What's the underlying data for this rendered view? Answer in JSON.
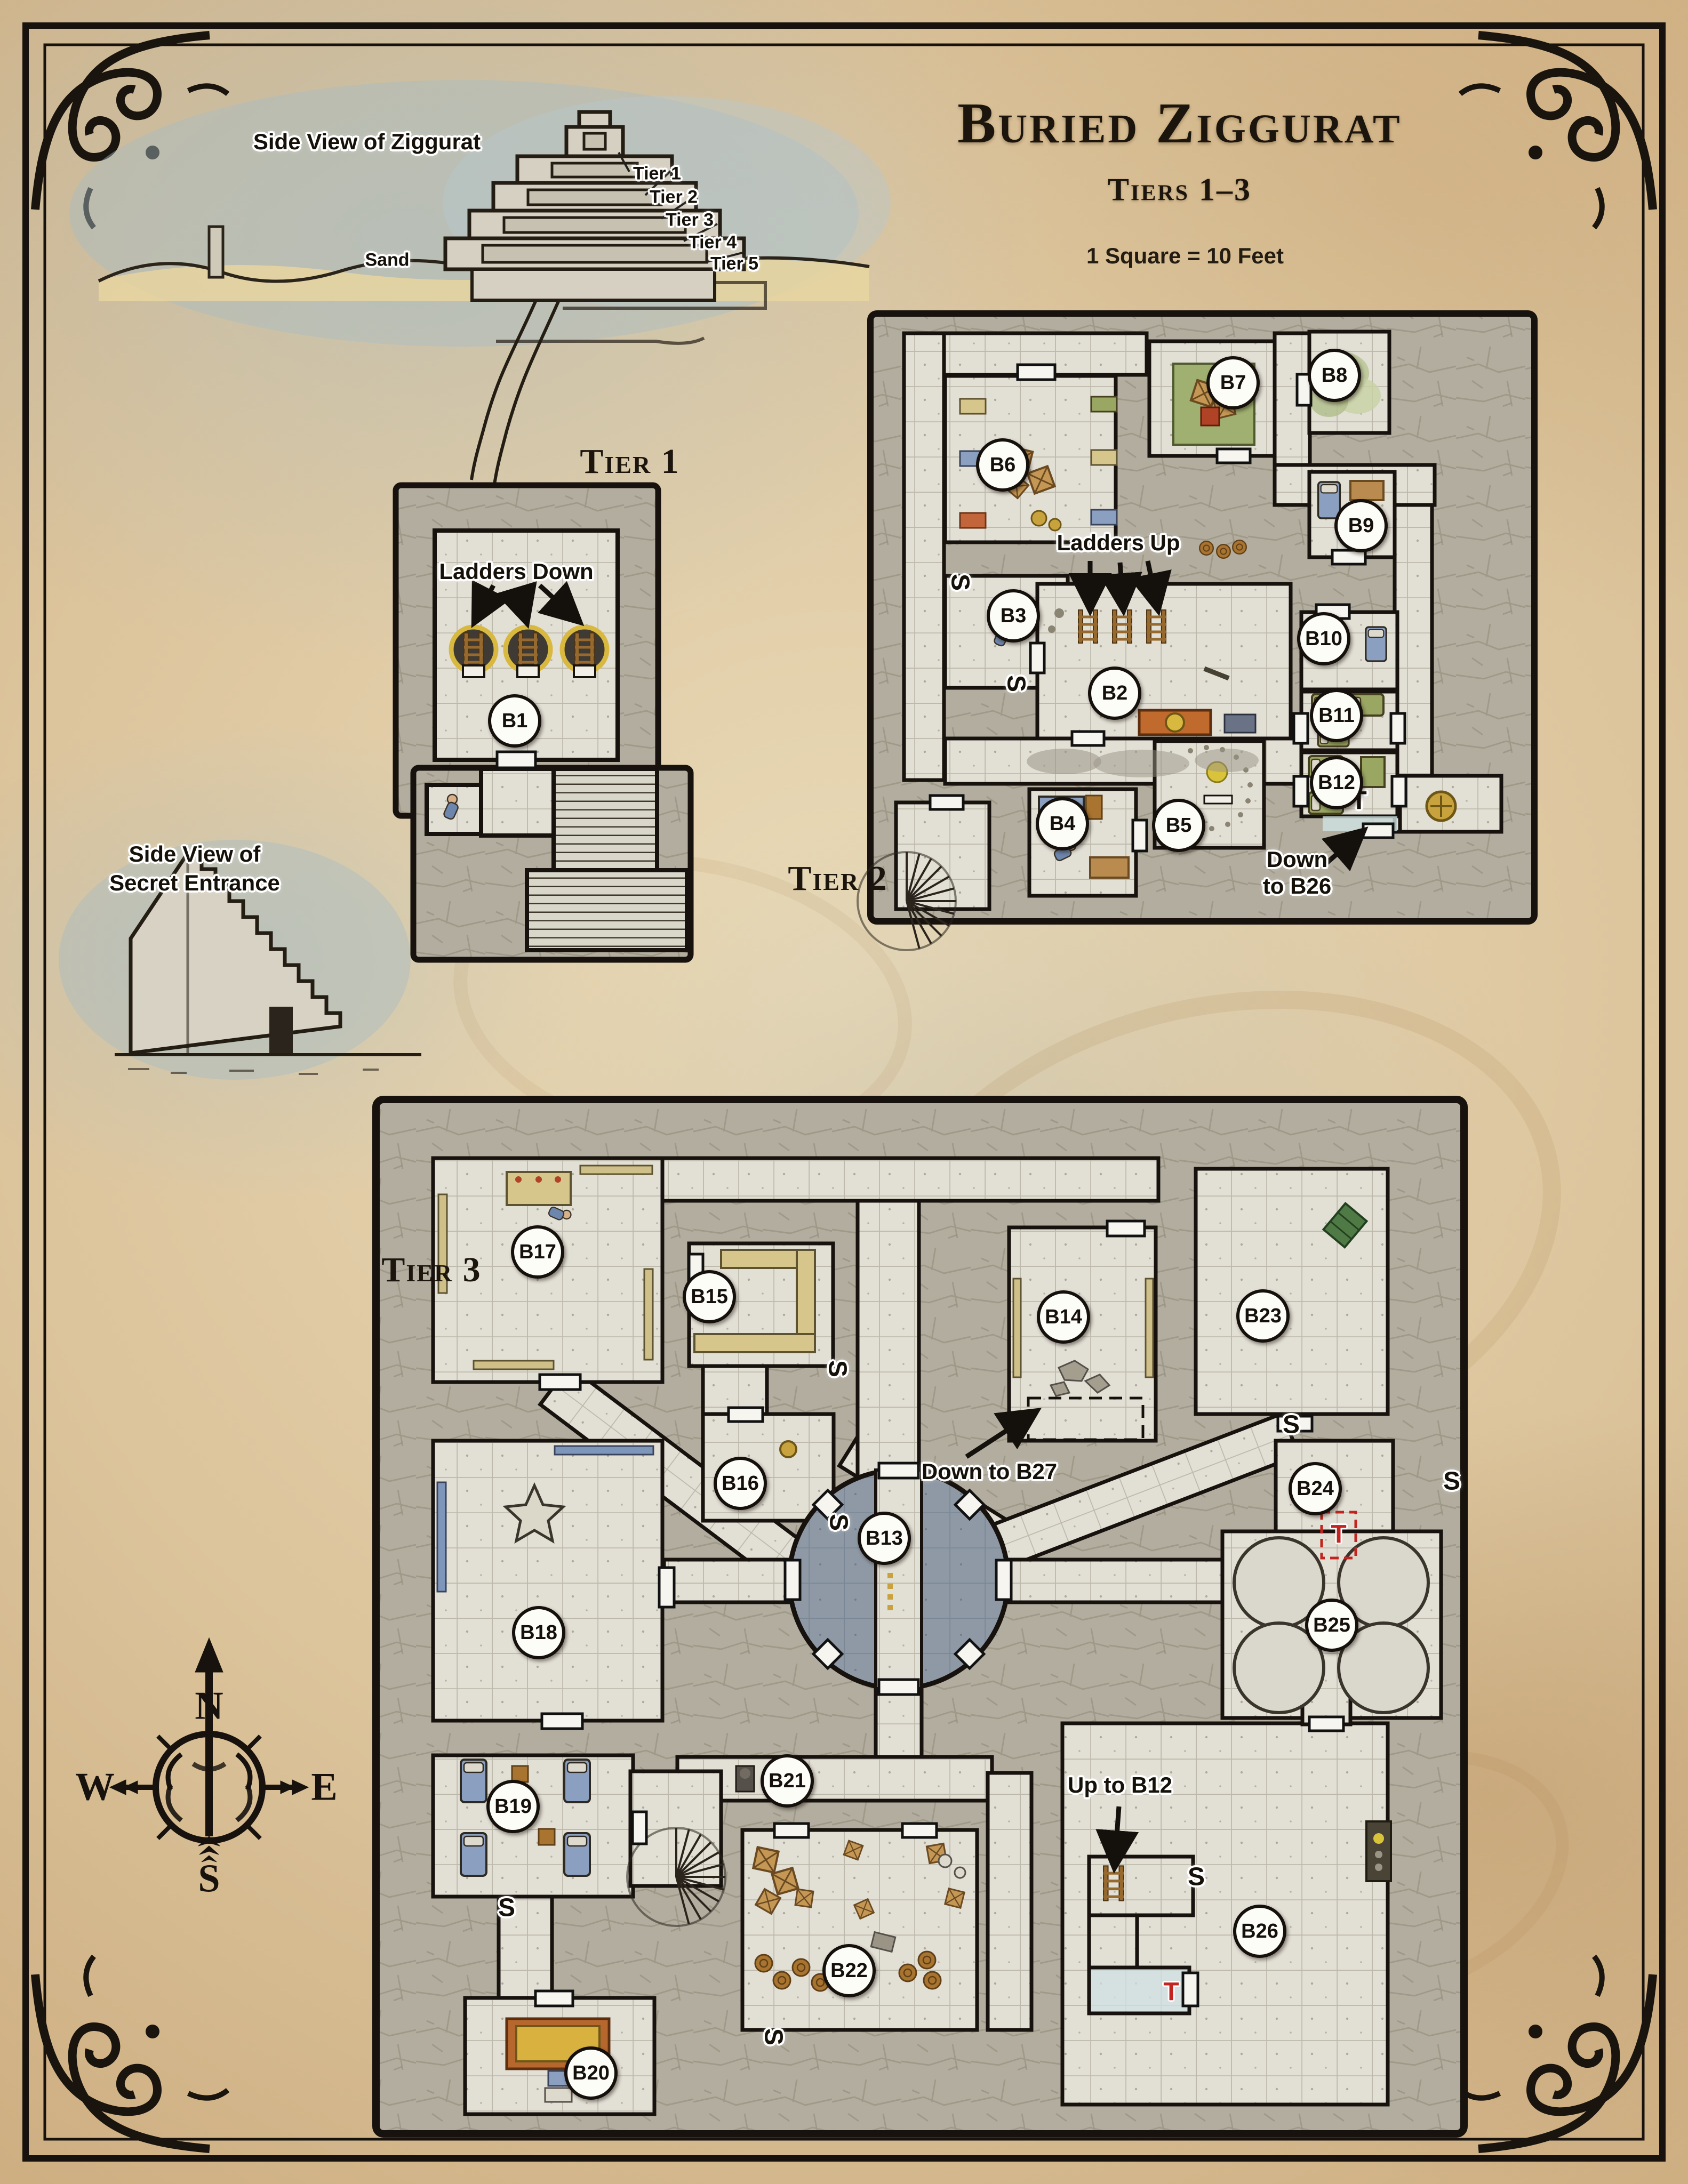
{
  "title": {
    "main": "Buried Ziggurat",
    "subtitle": "Tiers 1–3",
    "scale_note": "1 Square = 10 Feet"
  },
  "side_view_ziggurat": {
    "label": "Side View of Ziggurat",
    "sand_label": "Sand",
    "tier_callouts": [
      "Tier 1",
      "Tier 2",
      "Tier 3",
      "Tier 4",
      "Tier 5"
    ]
  },
  "side_view_secret": {
    "line1": "Side View of",
    "line2": "Secret Entrance"
  },
  "tier1": {
    "heading": "Tier 1",
    "ladders_label": "Ladders Down",
    "rooms": [
      {
        "id": "B1"
      }
    ]
  },
  "tier2": {
    "heading": "Tier 2",
    "ladders_label": "Ladders Up",
    "down_line1": "Down",
    "down_line2": "to B26",
    "rooms": [
      {
        "id": "B2"
      },
      {
        "id": "B3"
      },
      {
        "id": "B4"
      },
      {
        "id": "B5"
      },
      {
        "id": "B6"
      },
      {
        "id": "B7"
      },
      {
        "id": "B8"
      },
      {
        "id": "B9"
      },
      {
        "id": "B10"
      },
      {
        "id": "B11"
      },
      {
        "id": "B12"
      }
    ]
  },
  "tier3": {
    "heading": "Tier 3",
    "down_to_b27": "Down to B27",
    "up_to_b12": "Up to B12",
    "rooms": [
      {
        "id": "B13"
      },
      {
        "id": "B14"
      },
      {
        "id": "B15"
      },
      {
        "id": "B16"
      },
      {
        "id": "B17"
      },
      {
        "id": "B18"
      },
      {
        "id": "B19"
      },
      {
        "id": "B20"
      },
      {
        "id": "B21"
      },
      {
        "id": "B22"
      },
      {
        "id": "B23"
      },
      {
        "id": "B24"
      },
      {
        "id": "B25"
      },
      {
        "id": "B26"
      }
    ]
  },
  "markers": {
    "secret_door": "S",
    "trap": "T"
  },
  "compass": {
    "north": "N",
    "east": "E",
    "south": "S",
    "west": "W"
  },
  "colors": {
    "parchment": "#dcc49c",
    "stone_wall": "#b2ad9f",
    "floor": "#e2dfd5",
    "pool_room": "#8e99a5",
    "trap_red": "#c3241f",
    "gold": "#c8a23c",
    "ink": "#17120d"
  }
}
